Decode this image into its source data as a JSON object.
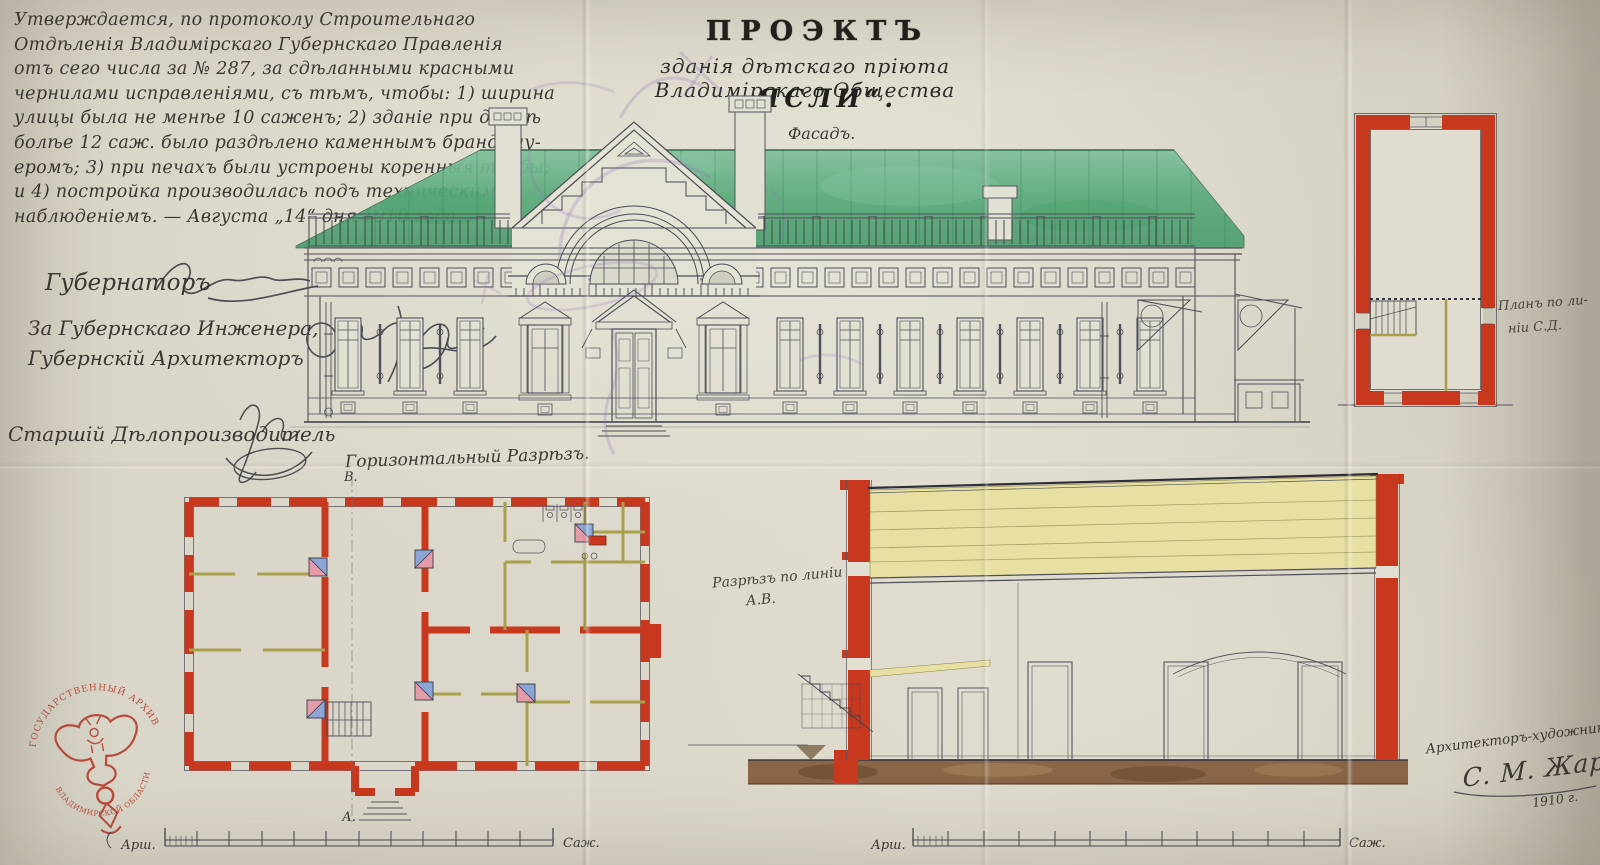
{
  "colors": {
    "paper": "#d8d4c7",
    "ink_line": "#4e4f58",
    "ink_dark": "#34353d",
    "wall_red": "#c8381e",
    "roof_green": "#58a97a",
    "attic_yellow": "#e7e0a2",
    "partition_olive": "#a9a04c",
    "stove_blue": "#8ba6d6",
    "stove_pink": "#e49cab",
    "foundation_brown": "#85603f",
    "stamp_red": "#b5392b",
    "violet_stamp": "#8b72b5"
  },
  "approval": {
    "lines": [
      "Утверждается, по протоколу Строительнаго",
      "Отдѣленія Владимірскаго Губернскаго Правленія",
      "отъ сего числа за № 287, за сдѣланными красными",
      "чернилами исправленіями, съ тѣмъ, чтобы: 1) ширина",
      "улицы была не менѣе 10 саженъ; 2) зданіе при длинѣ",
      "болѣе 12 саж. было раздѣлено каменнымъ брандмау-",
      "еромъ; 3) при печахъ были устроены коренныя трубы;",
      "и 4) постройка производилась подъ техническимъ",
      "наблюденіемъ. — Августа „14“ дня 1910 года. —"
    ]
  },
  "signatories": {
    "governor": "Губернаторъ",
    "engineer_line1": "За Губернскаго Инженера,",
    "engineer_line2": "Губернскій Архитекторъ",
    "clerk": "Старшій Дѣлопроизводитель"
  },
  "title": {
    "heading": "ПРОЭКТЪ",
    "subtitle": "зданія дѣтскаго пріюта Владимірскаго Общества",
    "building_name": "„ЯСЛИ“."
  },
  "drawing_labels": {
    "facade": "Фасадъ.",
    "floor_plan": "Горизонтальный Разрѣзъ.",
    "section_line1": "Разрѣзъ по линіи",
    "section_line2": "А.В.",
    "side_plan_line1": "Планъ по ли-",
    "side_plan_line2": "ніи С.Д.",
    "marker_top": "В.",
    "marker_bottom": "А."
  },
  "scale_bars": {
    "left": {
      "start": "Арш.",
      "end": "Саж."
    },
    "right": {
      "start": "Арш.",
      "end": "Саж."
    }
  },
  "architect": {
    "title": "Архитекторъ-художникъ",
    "name": "С. М. Жаровъ",
    "year": "1910 г."
  },
  "stamp": {
    "arc_top": "ГОСУДАРСТВЕННЫЙ АРХИВ",
    "arc_bottom": "ВЛАДИМИРСКОЙ ОБЛАСТИ"
  }
}
